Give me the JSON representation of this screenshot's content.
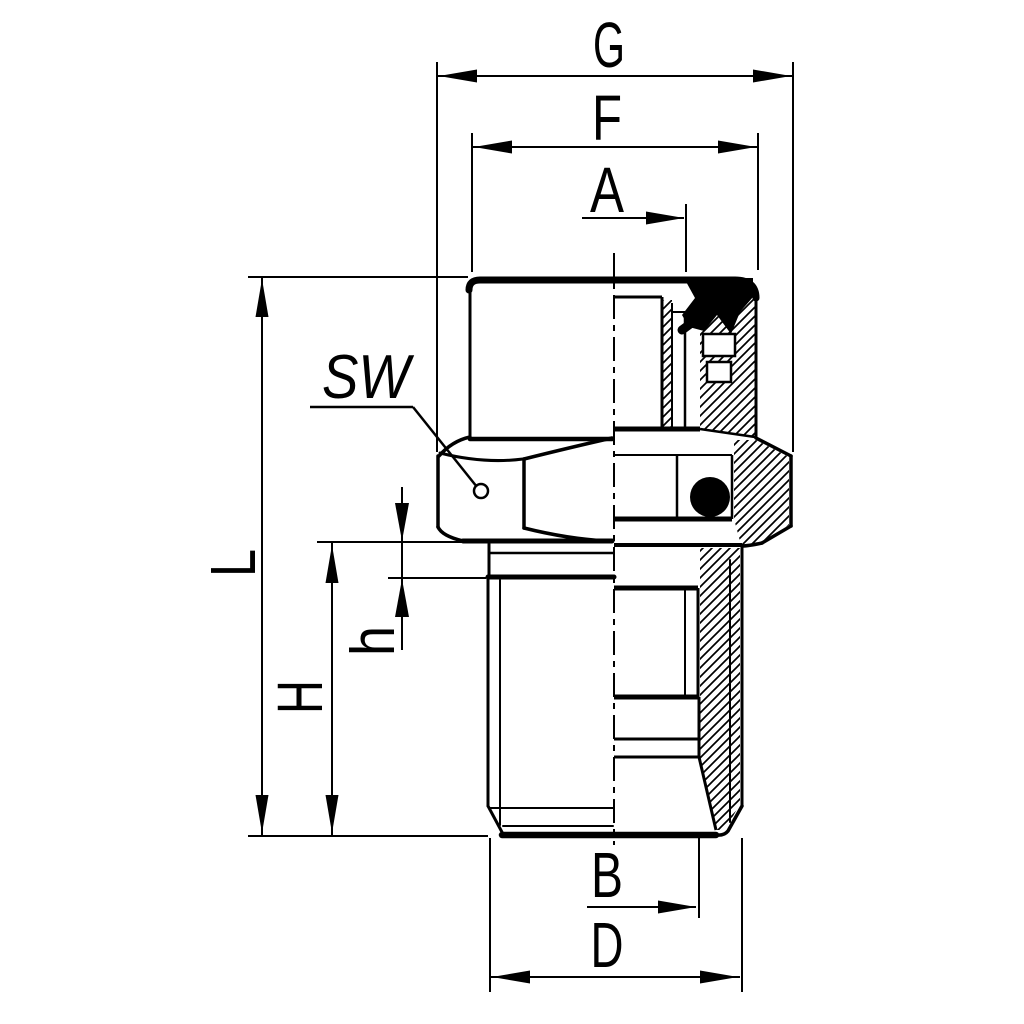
{
  "drawing": {
    "background": "#ffffff",
    "line_color": "#000000",
    "labels": {
      "g": "G",
      "f": "F",
      "a": "A",
      "sw": "SW",
      "l": "L",
      "h_upper": "H",
      "h_lower": "h",
      "b": "B",
      "d": "D"
    }
  }
}
